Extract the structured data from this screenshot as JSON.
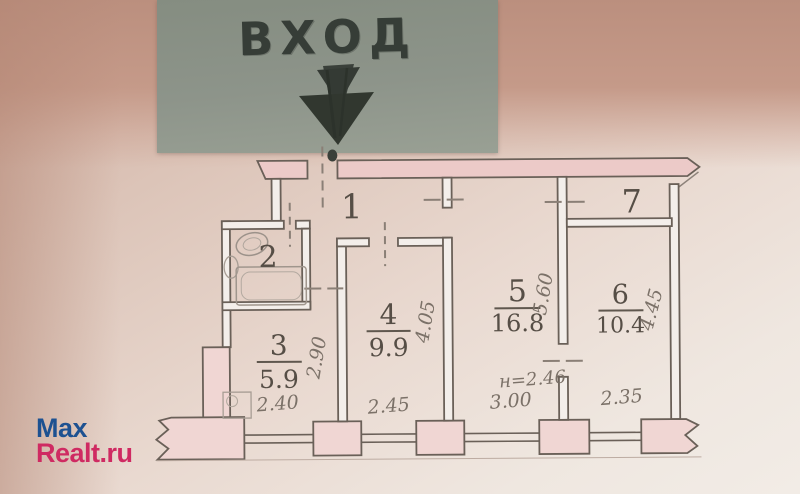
{
  "entrance_sign": {
    "label": "ВХОД"
  },
  "plan": {
    "hall_label": "1",
    "bath_label": "2",
    "room3": {
      "num": "3",
      "area": "5.9"
    },
    "room4": {
      "num": "4",
      "area": "9.9"
    },
    "room5": {
      "num": "5",
      "area": "16.8"
    },
    "room6": {
      "num": "6",
      "area": "10.4"
    },
    "room7_label": "7",
    "dims": {
      "bottom": [
        "2.40",
        "2.45",
        "3.00",
        "2.35"
      ],
      "room3_width": "2.90",
      "room4_width": "4.05",
      "room5_width": "5.60",
      "room6_width": "4.45",
      "ceiling_height": "н=2.46"
    }
  },
  "watermark": {
    "part1": "Max",
    "part2": "Realt.ru"
  },
  "colors": {
    "sign_background": "#8d948a",
    "ink": "#363d37",
    "wall_pink": "#eccac8",
    "plan_line": "#6a6058",
    "watermark_blue": "#1d5191",
    "watermark_red": "#cf2a62"
  }
}
